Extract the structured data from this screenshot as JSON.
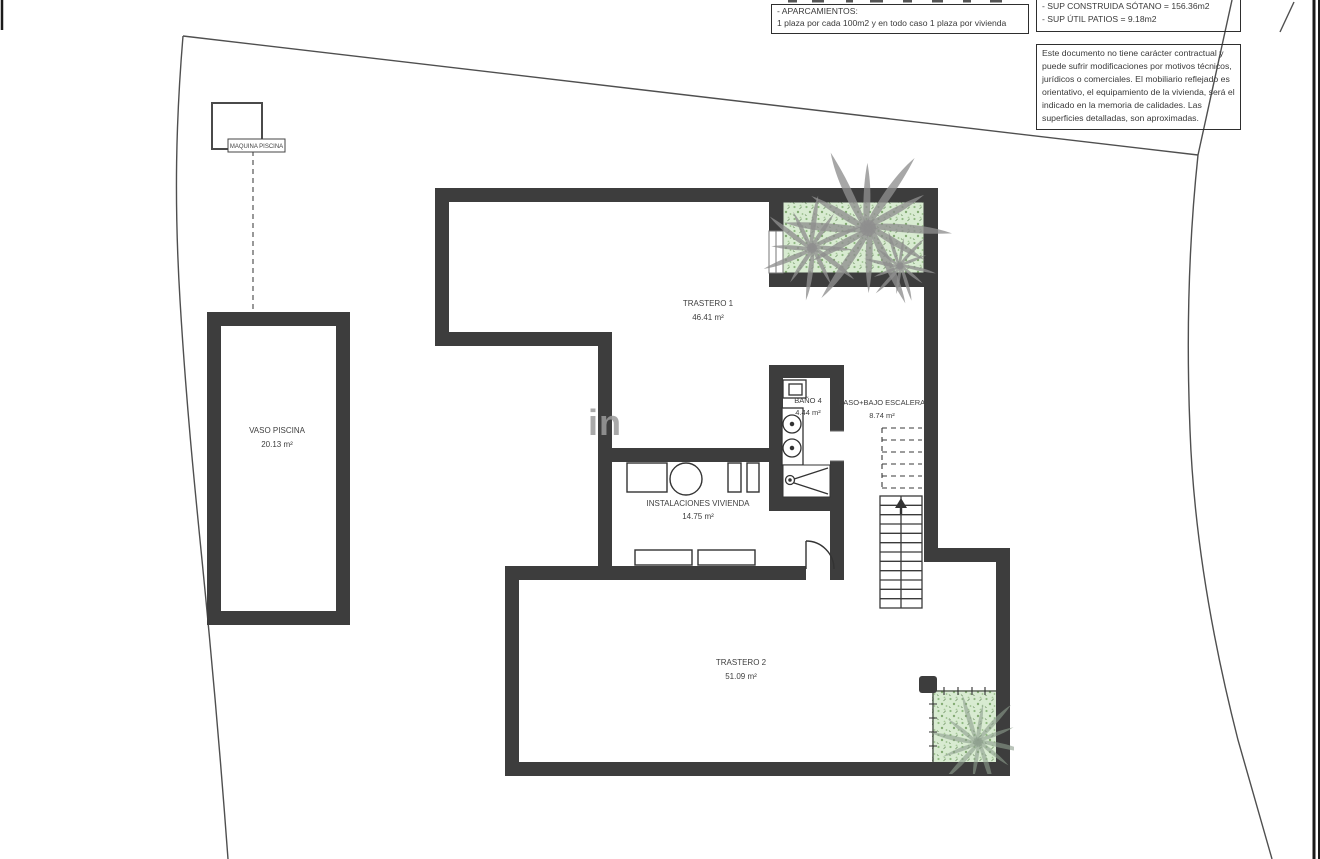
{
  "title_blocks": {
    "parking": {
      "label": "- APARCAMIENTOS:",
      "value": "1 plaza por cada 100m2 y en todo caso 1 plaza por vivienda"
    },
    "surfaces": {
      "sotano": "- SUP CONSTRUIDA SÓTANO =  156.36m2",
      "patios": "- SUP ÚTIL PATIOS =  9.18m2"
    },
    "disclaimer": "Este documento no tiene carácter contractual y puede sufrir modificaciones por motivos técnicos, jurídicos o comerciales. El mobiliario reflejado es orientativo, el equipamiento de la  vivienda, será el indicado en la memoria de calidades. Las superficies detalladas, son aproximadas."
  },
  "rooms": {
    "trastero1": {
      "name": "TRASTERO 1",
      "area": "46.41 m²"
    },
    "bano4": {
      "name": "BAÑO 4",
      "area": "4.44 m²"
    },
    "paso": {
      "name": "PASO+BAJO ESCALERA",
      "area": "8.74 m²"
    },
    "instalaciones": {
      "name": "INSTALACIONES VIVIENDA",
      "area": "14.75 m²"
    },
    "trastero2": {
      "name": "TRASTERO 2",
      "area": "51.09 m²"
    },
    "vaso_piscina": {
      "name": "VASO PISCINA",
      "area": "20.13 m²"
    },
    "maquina_piscina": {
      "name": "MAQUINA PISCINA"
    }
  },
  "watermark": "in",
  "colors": {
    "wall": "#3d3d3d",
    "boundary": "#4f4f4f",
    "patio_green": "#d8ebd1",
    "palm_gray": "#8e8e8e",
    "frame": "#1a1a1a"
  }
}
